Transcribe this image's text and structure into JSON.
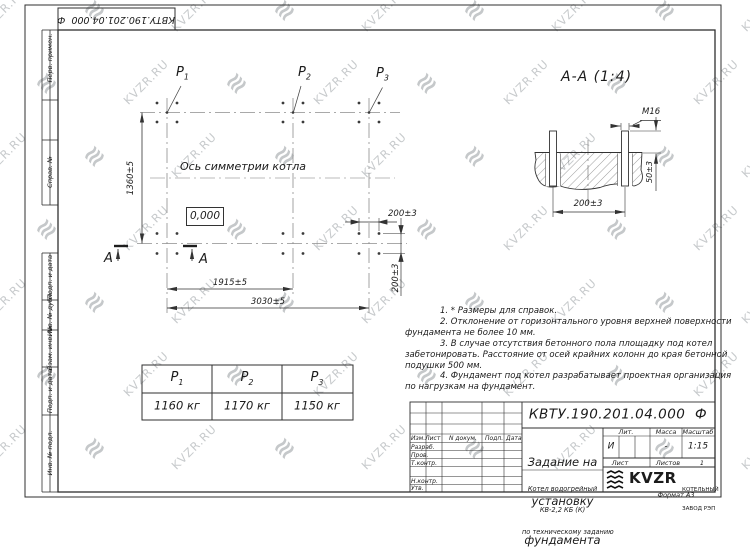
{
  "watermark": {
    "text": "KVZR.RU"
  },
  "stamp_top": {
    "text": "КВТУ.190.201.04.000  Ф"
  },
  "margin_labels": [
    "Перв. примен.",
    "Справ. №",
    "Подп. и дата",
    "Инв. № дубл.",
    "Взам. инв. №",
    "Подп. и дата",
    "Инв. № подл."
  ],
  "plan": {
    "points": [
      {
        "label": "P",
        "sub": "1",
        "load": "1160 кг"
      },
      {
        "label": "P",
        "sub": "2",
        "load": "1170 кг"
      },
      {
        "label": "P",
        "sub": "3",
        "load": "1150 кг"
      }
    ],
    "axis_label": "Ось симметрии котла",
    "level_mark": "0,000",
    "dim_height": "1360±5",
    "dim_width_mid": "1915±5",
    "dim_width_total": "3030±5",
    "dim_bolt_h": "200±3",
    "dim_bolt_v": "200±3",
    "section_letter": "А"
  },
  "section": {
    "title": "А-А (1:4)",
    "thread": "М16",
    "dim_width": "200±3",
    "dim_protrusion": "50±3"
  },
  "notes": {
    "lines": [
      "1. * Размеры для справок.",
      "2. Отклонение от горизонтального уровня верхней поверхности",
      "фундамента не более 10 мм.",
      "3. В случае отсутствия бетонного пола площадку под котел",
      "забетонировать. Расстояние от осей крайних колонн до края бетонной",
      "подушки 500 мм.",
      "4. Фундамент под котел разрабатывает проектная организация",
      "по нагрузкам на фундамент."
    ]
  },
  "title_block": {
    "designation": "КВТУ.190.201.04.000  Ф",
    "doc_title": [
      "Задание на",
      "установку",
      "фундамента"
    ],
    "product": [
      "Котел водогрейный",
      "КВ-2,2 КБ (К)",
      "по техническому заданию"
    ],
    "header_cols": [
      "Изм.Лист",
      "N докум.",
      "Подп.",
      "Дата"
    ],
    "sig_rows": [
      "Разраб.",
      "Пров.",
      "Т.контр.",
      "",
      "Н.контр.",
      "Утв."
    ],
    "lit": {
      "label": "Лит.",
      "value": "И"
    },
    "massa": {
      "label": "Масса",
      "value": "-"
    },
    "scale": {
      "label": "Масштаб",
      "value": "1:15"
    },
    "sheet": {
      "label": "Лист",
      "value": ""
    },
    "sheets": {
      "label": "Листов",
      "value": "1"
    },
    "logo": {
      "text": "KVZR",
      "sub1": "КОТЕЛЬНЫЙ",
      "sub2": "ЗАВОД РЭП"
    },
    "format": "Формат А3"
  }
}
